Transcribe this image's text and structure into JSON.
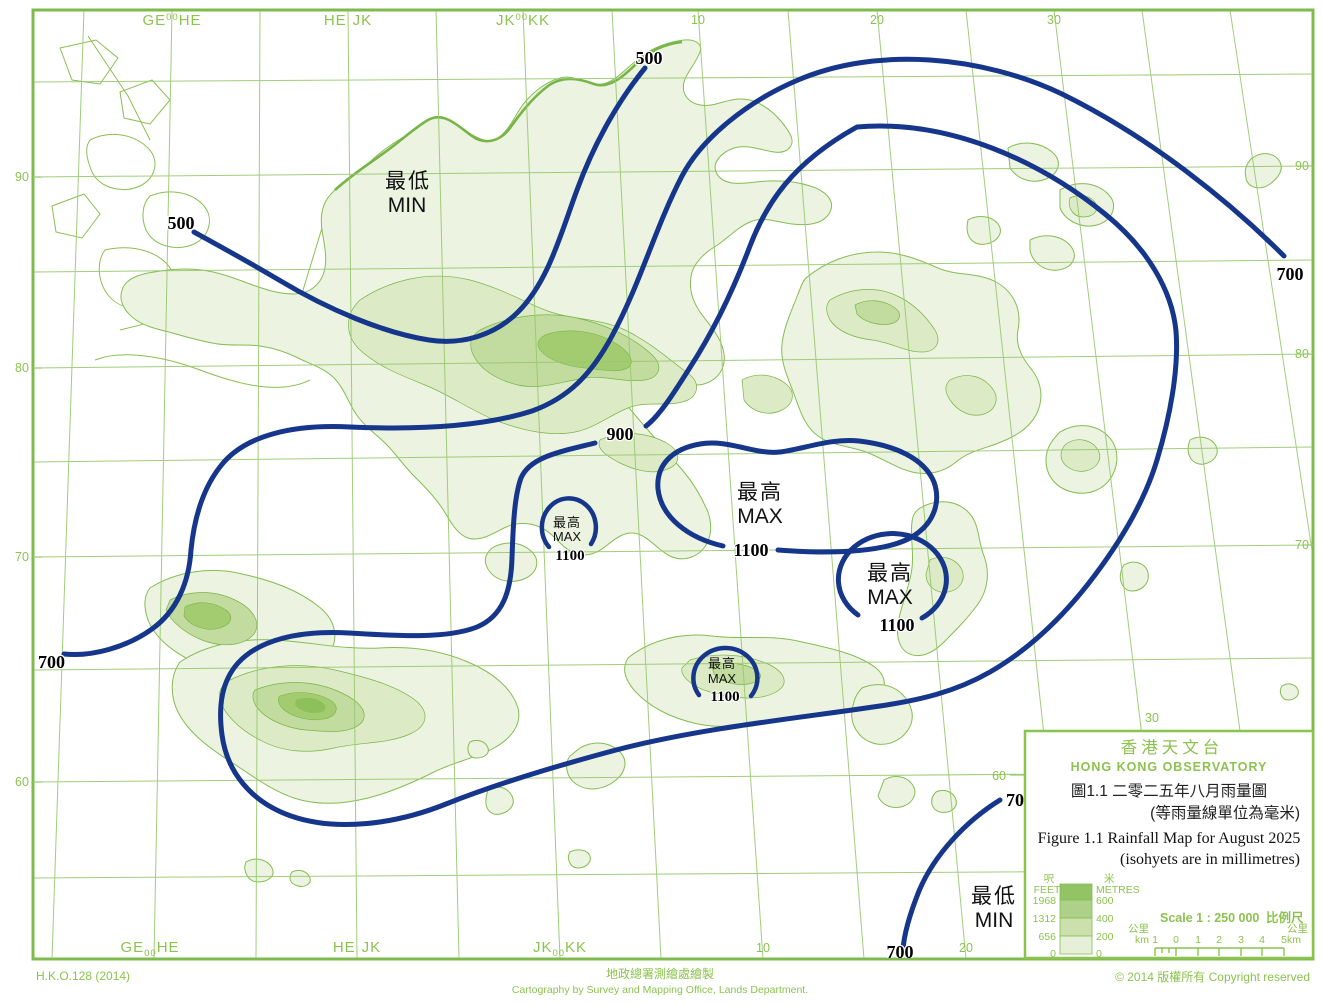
{
  "map": {
    "grid": {
      "zones": [
        {
          "a": "GE",
          "n": "00",
          "b": "HE"
        },
        {
          "a": "HE",
          "n": "",
          "b": "JK"
        },
        {
          "a": "JK",
          "n": "00",
          "b": "KK"
        }
      ],
      "top_ticks": [
        "10",
        "20",
        "30"
      ],
      "bottom_ticks": [
        "10",
        "20"
      ],
      "inner_tick_30": "30",
      "inner_tick_60": "60",
      "left_ticks": [
        "90",
        "80",
        "70",
        "60"
      ],
      "right_ticks": [
        "90",
        "80",
        "70"
      ]
    },
    "isohyet_values": {
      "v500": "500",
      "v700": "700",
      "v900": "900",
      "v1100": "1100"
    },
    "annotations": {
      "min_zh": "最低",
      "min_en": "MIN",
      "max_zh": "最高",
      "max_en": "MAX"
    }
  },
  "legend": {
    "title_zh": "香港天文台",
    "title_en": "HONG KONG OBSERVATORY",
    "caption_zh": "圖1.1  二零二五年八月雨量圖",
    "caption_zh2": "(等雨量線單位為毫米)",
    "caption_en": "Figure 1.1 Rainfall Map for August 2025",
    "caption_en2": "(isohyets are in millimetres)",
    "elevation": {
      "feet_zh": "呎",
      "feet_en": "FEET",
      "metres_zh": "米",
      "metres_en": "METRES",
      "feet": [
        "1968",
        "1312",
        "656",
        "0"
      ],
      "metres": [
        "600",
        "400",
        "200",
        "0"
      ],
      "colors": [
        "#92c465",
        "#aed189",
        "#cbe0ad",
        "#e6efd7"
      ]
    },
    "scale_text": "Scale 1 : 250 000",
    "scale_text_zh": "比例尺",
    "scalebar": {
      "km_zh": "公里",
      "km_en": "km",
      "ticks": [
        "1",
        "0",
        "1",
        "2",
        "3",
        "4",
        "5"
      ]
    }
  },
  "footer": {
    "ref": "H.K.O.128 (2014)",
    "cartography_zh": "地政總署測繪處繪製",
    "cartography_en": "Cartography by Survey and Mapping Office, Lands Department.",
    "copyright": "© 2014  版權所有   Copyright reserved"
  },
  "colors": {
    "isohyet": "#15368a",
    "grid_green": "#97c86e",
    "accent_green": "#8cc34f"
  }
}
